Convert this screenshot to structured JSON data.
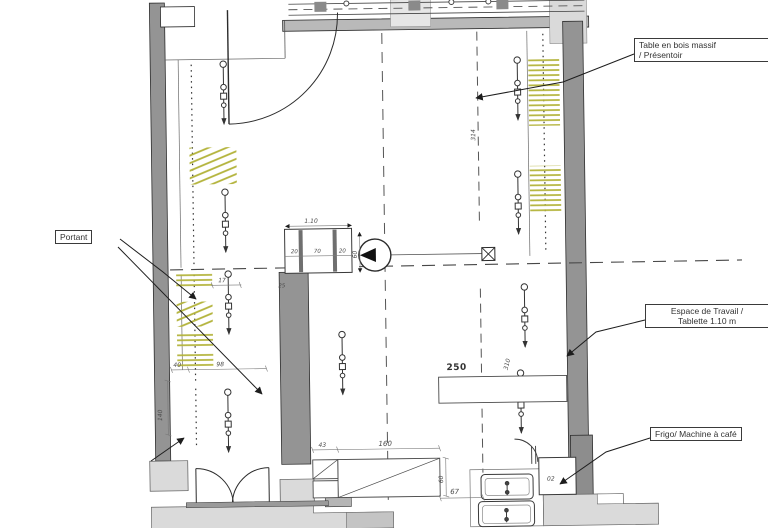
{
  "annotations": {
    "table": {
      "line1": "Table en bois massif",
      "line2": "/ Présentoir"
    },
    "portant": {
      "text": "Portant"
    },
    "espace": {
      "line1": "Espace de Travail /",
      "line2": "Tablette  1.10 m"
    },
    "frigo": {
      "text": "Frigo/ Machine à café"
    }
  },
  "dimensions": {
    "d17": "17",
    "d40": "40",
    "d98": "98",
    "d140": "140",
    "d25": "25",
    "d110": "1.10",
    "d20a": "20",
    "d70": "70",
    "d20b": "20",
    "d60": "60",
    "d314": "314",
    "d310": "310",
    "d250": "250",
    "d43": "43",
    "d160": "160",
    "d60b": "60",
    "d67": "67",
    "d02": "02"
  },
  "colors": {
    "wall": "#949494",
    "slab": "#dadada",
    "hatch": "#b3b33a",
    "line": "#3c3c3c",
    "dim": "#4a4a4a"
  }
}
